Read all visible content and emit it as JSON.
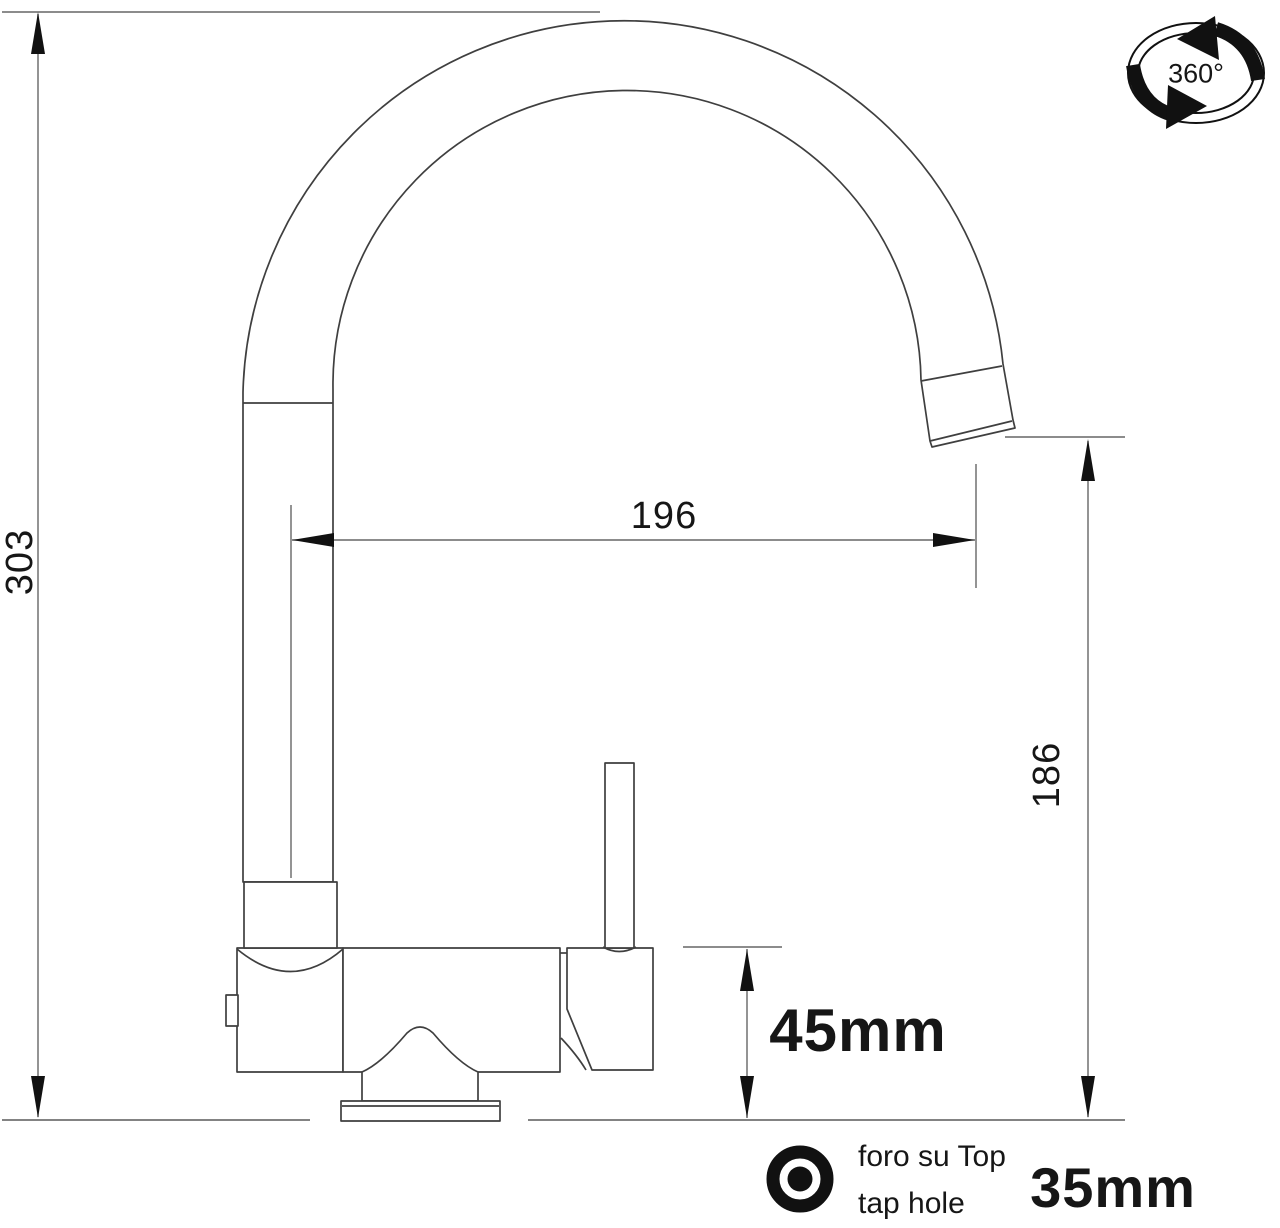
{
  "drawing": {
    "dims": {
      "total_height": "303",
      "reach": "196",
      "outlet_height": "186",
      "body_height": "45mm",
      "hole": "35mm"
    },
    "rotation_label": "360°",
    "hole_note": {
      "line1": "foro su Top",
      "line2": "tap hole"
    }
  },
  "colors": {
    "background": "#ffffff",
    "outline": "#3f3f3f",
    "dimension_line": "#666666",
    "ink": "#111111"
  }
}
